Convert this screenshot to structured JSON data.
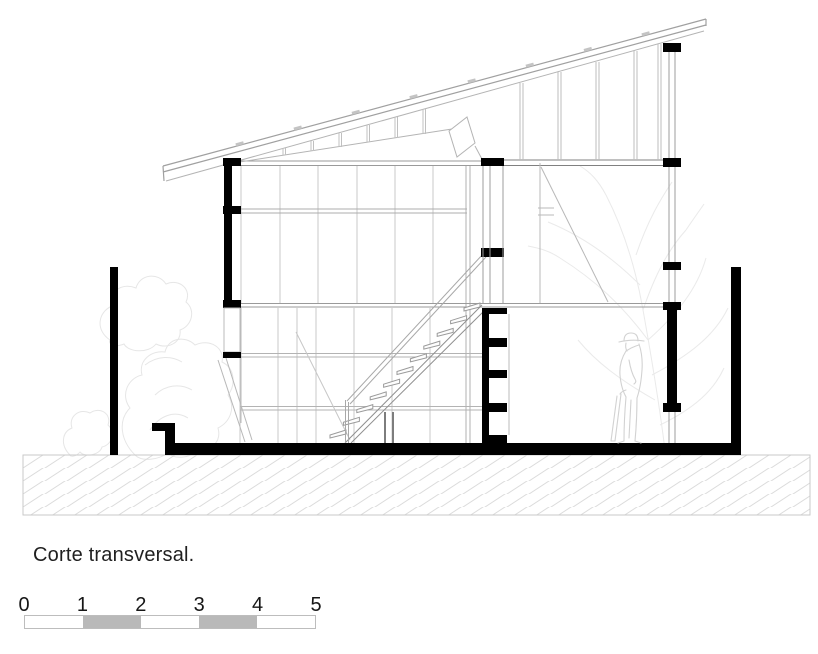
{
  "title": {
    "text": "Corte transversal."
  },
  "scale_bar": {
    "labels": [
      "0",
      "1",
      "2",
      "3",
      "4",
      "5"
    ],
    "tick_positions_px": [
      24,
      82.4,
      140.8,
      199.2,
      257.6,
      316
    ],
    "filled_segments": [
      1,
      3
    ],
    "segment_fill": "#b9b9b9",
    "border_color": "#bdbdbd"
  },
  "palette": {
    "cut_ink": "#000000",
    "medium_line": "#999999",
    "light_line": "#c9c9c9",
    "faint_sketch": "#e6e6e6",
    "hatch_line": "#dcdcdc",
    "background": "#ffffff",
    "text": "#1f1f1f"
  },
  "elements": [
    "mono-pitch-roof-truss",
    "clerestory-band",
    "left-cut-wall",
    "mid-steel-column",
    "right-steel-column",
    "staircase",
    "stepped-louver-wall",
    "floor-slab",
    "ground-hatch",
    "garden-wall-left",
    "garden-wall-right",
    "human-scale-figure",
    "tree-sketch-left",
    "tree-sketch-right"
  ]
}
